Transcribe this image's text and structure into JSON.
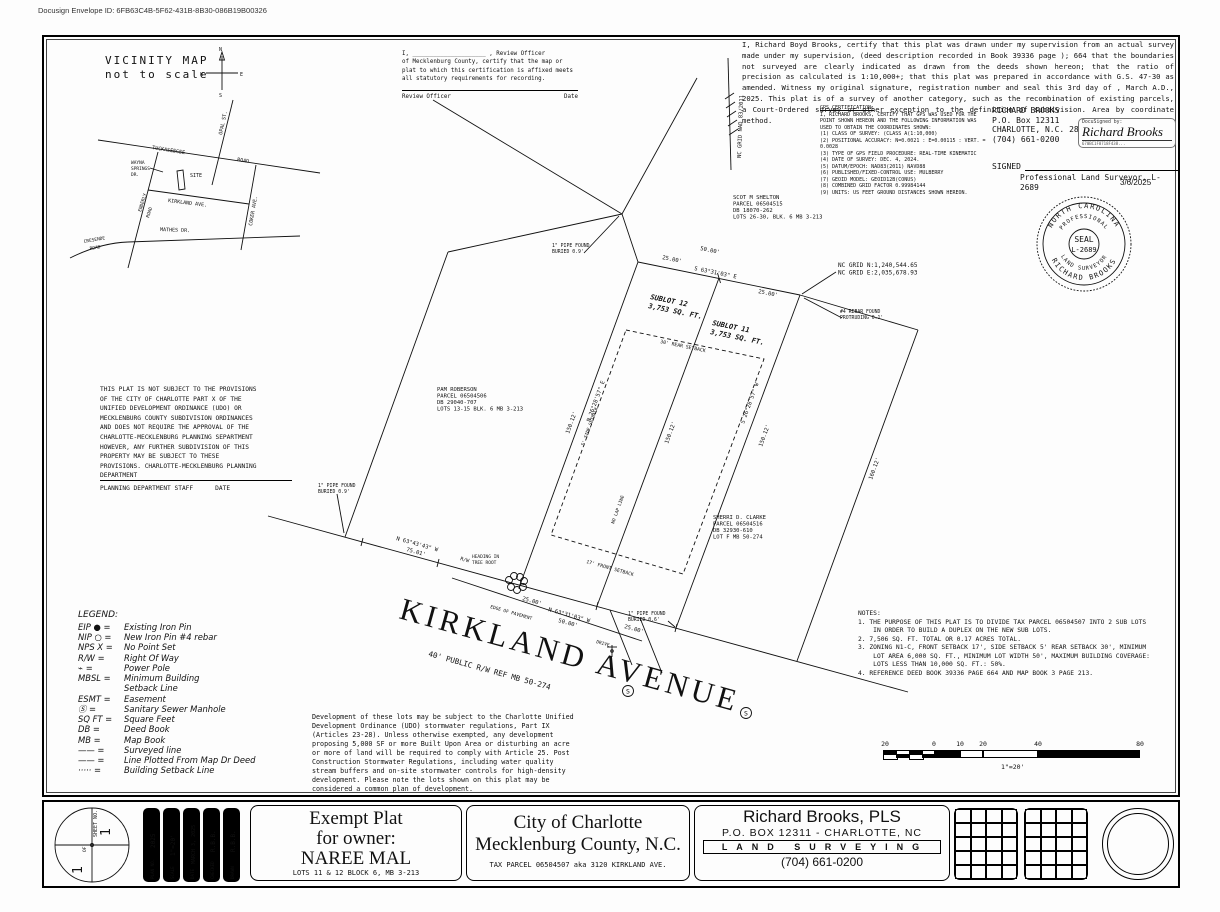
{
  "page": {
    "docusign_id": "Docusign Envelope ID: 6FB63C4B-5F62-431B-8B30-086B19B00326"
  },
  "vicinity": {
    "title": "VICINITY MAP",
    "subtitle": "not to scale",
    "compass": {
      "n": "N",
      "s": "S",
      "e": "E",
      "w": "W"
    },
    "roads": {
      "tuckaseegee": "TUCKASEEGEE",
      "road": "ROAD",
      "opal": "OPAL ST.",
      "wayna1": "WAYNA",
      "wayna2": "SPRINGS",
      "wayna3": "DR.",
      "enderly1": "ENDERLY",
      "enderly2": "ROAD",
      "kirkland": "KIRKLAND  AVE.",
      "coker": "COKER AVE.",
      "mathes": "MATHES  DR.",
      "cresende1": "CRESENDE",
      "cresende2": "ROAD",
      "site": "SITE"
    }
  },
  "review": {
    "line1": "I, _____________________ , Review Officer",
    "body": "of Mecklenburg County, certify that the map or plat to which this certification is affixed meets all statutory requirements for recording.",
    "officer_label": "Review Officer",
    "date_label": "Date"
  },
  "cert": {
    "body": "    I, Richard Boyd Brooks, certify that this plat was drawn under my supervision from an actual survey made under my supervision, (deed description recorded in Book 39336 page ); 664 that the boundaries not surveyed are clearly indicated as drawn from the deeds shown hereon; that the ratio of precision as calculated is 1:10,000+; that this plat was prepared in accordance with G.S. 47-30 as amended. Witness my original signature, registration number and seal this 3rd day of , March A.D., 2025. This plat is of a survey of another category, such as the recombination of existing parcels, a Court-Ordered survey or other exception to the definition of subdivision. Area by coordinate method."
  },
  "gps": {
    "title": "GPS CERTIFICATION:",
    "intro": "I, RICHARD BROOKS, CERTIFY THAT GPS WAS USED FOR THE POINT SHOWN HEREON AND THE FOLLOWING INFORMATION WAS USED TO OBTAIN THE COORDINATES SHOWN:",
    "items": [
      "(1) CLASS OF SURVEY: (CLASS A(1:10,000)",
      "(2) POSITIONAL ACCURACY: N=0.0021 : E=0.00115 : VERT. = 0.0028",
      "(3) TYPE OF GPS FIELD PROCEDURE: REAL-TIME KINEMATIC",
      "(4) DATE OF SURVEY: DEC. 4, 2024.",
      "(5) DATUM/EPOCH: NAD83(2011) NAVD88",
      "(6) PUBLISHED/FIXED-CONTROL USE: MULBERRY",
      "(7) GEOID MODEL: GEOID12B(CONUS)",
      "(8) COMBINED GRID FACTOR 0.99984144",
      "(9) UNITS: US FEET GROUND DISTANCES SHOWN HEREON."
    ]
  },
  "surveyor": {
    "name": "RICHARD BROOKS",
    "po": "P.O. Box 12311",
    "city": "CHARLOTTE, N.C. 28220",
    "phone": "(704) 661-0200",
    "signed_label": "SIGNED",
    "title": "Professional Land Surveyor, L-2689",
    "date": "3/6/2025",
    "docusigned_by": "DocuSigned by:",
    "signature": "Richard Brooks",
    "sig_id": "670BC1F8718F438..."
  },
  "seal": {
    "top": "NORTH CAROLINA",
    "inner_top": "PROFESSIONAL",
    "center1": "SEAL",
    "center2": "L-2689",
    "inner_bottom": "LAND SURVEYOR",
    "bottom": "RICHARD BROOKS"
  },
  "plat": {
    "shelton": [
      "SCOT M SHELTON",
      "PARCEL 06504515",
      "DB 18070-262",
      "LOTS 26-30, BLK. 6 MB 3-213"
    ],
    "roberson": [
      "PAM ROBERSON",
      "PARCEL 06504506",
      "DB 29040-707",
      "LOTS 13-15 BLK. 6 MB 3-213"
    ],
    "clarke": [
      "SHERRI D. CLARKE",
      "PARCEL 06504516",
      "DB 32930-610",
      "LOT F MB 50-274"
    ],
    "grid_n": "NC GRID N:1,240,544.65",
    "grid_e": "NC GRID E:2,035,678.93",
    "grid_axis": "NC GRID  NAD 83/2011",
    "sublot12a": "SUBLOT 12",
    "sublot12b": "3,753 SQ. FT.",
    "sublot11a": "SUBLOT 11",
    "sublot11b": "3,753 SQ. FT.",
    "rear_total": "50.00'",
    "rear_left": "25.00'",
    "rear_right": "25.00'",
    "rear_bearing": "S 63°31'03\" E",
    "front_total": "50.00'",
    "front_left": "25.00'",
    "front_right": "25.00'",
    "front_bearing": "N 63°31'03\" W",
    "rw_bearing": "N 63°43'43\" W",
    "rw_dist": "75.01'",
    "rw_label": "R/W",
    "side_left_bearing": "N 26°28'57\" E",
    "side_left_dist": "150.12'",
    "mid_dist": "150.12'",
    "lap": "NO LAP LINE",
    "side_right_bearing": "S 26°28'57\" W",
    "side_right_dist": "150.12'",
    "far_dist": "160.12'",
    "rebar1": "#4 REBAR FOUND",
    "rebar2": "PROTRUDING 0.1'",
    "pipe_b1": "1\" PIPE FOUND",
    "pipe_b2": "BURIED 0.9'",
    "pipe_e1": "1\" PIPE FOUND",
    "pipe_e2": "BURIED 0.9'",
    "pipe_f1": "1\" PIPE FOUND",
    "pipe_f2": "BURIED 0.6'",
    "setback_rear": "30' REAR SETBACK",
    "setback_front": "17' FRONT SETBACK",
    "setback_side": "5' SIDE SETBACK",
    "heading1": "HEADING IN",
    "heading2": "TREE ROOT",
    "edge_pavement": "EDGE OF PAVEMENT",
    "drive": "DRIVE",
    "street": "KIRKLAND AVENUE",
    "street_sub": "40' PUBLIC R/W  REF MB 50-274",
    "manhole": "S"
  },
  "not_subject": {
    "body": "THIS PLAT IS NOT SUBJECT TO THE PROVISIONS\nOF THE CITY OF CHARLOTTE PART X OF THE\nUNIFIED DEVELOPMENT ORDINANCE (UDO) OR\nMECKLENBURG COUNTY SUBDIVISION ORDINANCES\nAND DOES NOT REQUIRE THE APPROVAL OF THE\nCHARLOTTE-MECKLENBURG PLANNING SEPARTMENT\nHOWEVER, ANY FURTHER SUBDIVISION OF THIS\nPROPERTY MAY BE SUBJECT TO THESE\nPROVISIONS. CHARLOTTE-MECKLENBURG PLANNING\nDEPARTMENT",
    "staff_label": "PLANNING DEPARTMENT STAFF",
    "date_label": "DATE"
  },
  "legend": {
    "title": "LEGEND:",
    "items": [
      {
        "sym": "EIP ● =",
        "text": "Existing Iron Pin"
      },
      {
        "sym": "NIP ○ =",
        "text": "New Iron Pin #4 rebar"
      },
      {
        "sym": "NPS X =",
        "text": "No Point Set"
      },
      {
        "sym": "R/W  =",
        "text": "Right Of Way"
      },
      {
        "sym": "⌁   =",
        "text": "Power Pole"
      },
      {
        "sym": "MBSL =",
        "text": "Minimum Building\nSetback Line"
      },
      {
        "sym": "ESMT =",
        "text": "Easement"
      },
      {
        "sym": "Ⓢ  =",
        "text": "Sanitary Sewer Manhole"
      },
      {
        "sym": "SQ FT =",
        "text": "Square Feet"
      },
      {
        "sym": "DB  =",
        "text": "Deed Book"
      },
      {
        "sym": "MB  =",
        "text": "Map Book"
      },
      {
        "sym": "—— =",
        "text": "Surveyed line"
      },
      {
        "sym": "—— =",
        "text": "Line Plotted From Map Dr Deed"
      },
      {
        "sym": "····· =",
        "text": "Building Setback Line"
      }
    ]
  },
  "notes": {
    "title": "NOTES:",
    "items": [
      "1. THE PURPOSE OF THIS PLAT IS TO DIVIDE TAX PARCEL 06504507 INTO 2 SUB LOTS\n    IN ORDER TO BUILD A DUPLEX ON THE NEW SUB LOTS.",
      "2. 7,506 SQ. FT. TOTAL OR 0.17 ACRES TOTAL.",
      "3. ZONING N1-C, FRONT SETBACK 17', SIDE SETBACK 5' REAR SETBACK 30', MINIMUM\n    LOT AREA 6,000 SQ. FT., MINIMUM LOT WIDTH 50', MAXIMUM BUILDING COVERAGE:\n    LOTS LESS THAN 10,000 SQ. FT.: 50%.",
      "4. REFERENCE DEED BOOK 39336 PAGE 664 AND MAP BOOK 3 PAGE 213."
    ]
  },
  "storm": {
    "body": "Development of these lots may be subject to the Charlotte Unified\nDevelopment Ordinance (UDO) stormwater regulations, Part IX\n(Articles 23-28). Unless otherwise exempted, any development\nproposing 5,000 SF or more Built Upon Area or disturbing an acre\nor more of land will be required to comply with Article 25. Post\nConstruction Stormwater Regulations, including water quality\nstream buffers and on-site stormwater controls for high-density\ndevelopment. Please note the lots shown on this plat may be\nconsidered a common plan of development."
  },
  "scalebar": {
    "labels": [
      "20",
      "0",
      "10",
      "20",
      "40",
      "80"
    ],
    "caption": "1\"=20'"
  },
  "blocks": {
    "exempt": {
      "l1": "Exempt Plat",
      "l2": "for owner:",
      "l3": "NAREE MAL",
      "sub": "LOTS 11 & 12 BLOCK 6, MB 3-213"
    },
    "city": {
      "l1": "City of Charlotte",
      "l2": "Mecklenburg County, N.C.",
      "sub": "TAX PARCEL 06504507 aka 3120 KIRKLAND AVE."
    },
    "firm": {
      "name": "Richard Brooks, PLS",
      "addr": "P.O. BOX 12311 - CHARLOTTE, NC",
      "land": "LAND SURVEYING",
      "phone": "(704) 661-0200"
    }
  },
  "sheetinfo": {
    "sheet_label": "SHEET NO.",
    "num1": "1",
    "of": "OF",
    "num2": "1",
    "strips": [
      {
        "label": "PLAN NO.",
        "value": "2025"
      },
      {
        "label": "SCALE",
        "value": "1\"=20'"
      },
      {
        "label": "DATE",
        "value": "MARCH 3, 2025"
      },
      {
        "label": "CHECKED",
        "value": "R.B.B."
      },
      {
        "label": "DRAWN",
        "value": "R.B.B."
      }
    ]
  }
}
